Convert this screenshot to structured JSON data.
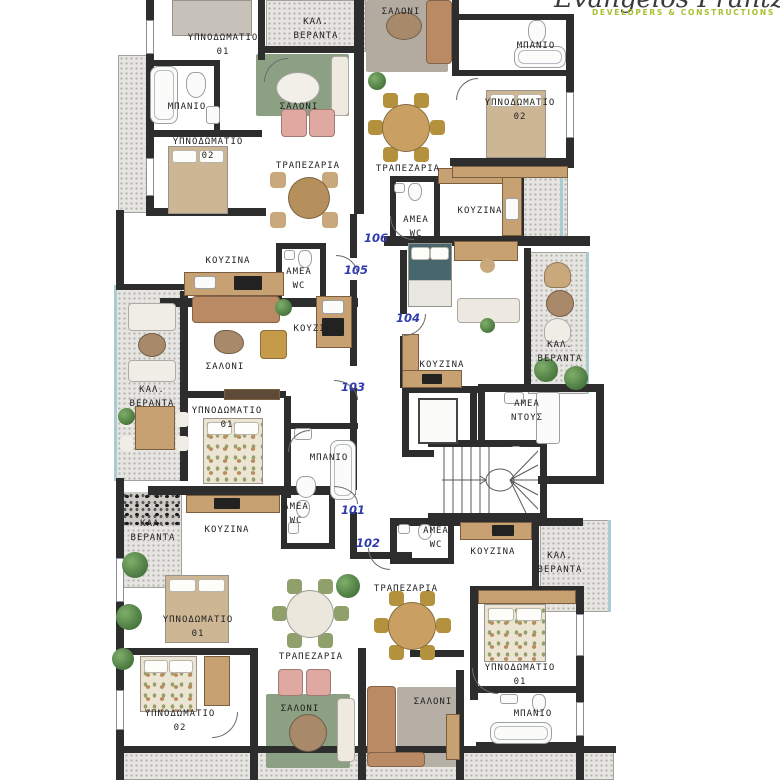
{
  "brand": {
    "name": "Evangelos Frantzis",
    "tagline": "DEVELOPERS & CONSTRUCTIONS"
  },
  "room_names": {
    "bedroom01": "ΥΠΝΟΔΩΜΑΤΙΟ\n01",
    "bedroom02": "ΥΠΝΟΔΩΜΑΤΙΟ\n02",
    "bathroom": "ΜΠΑΝΙΟ",
    "salon": "ΣΑΛΟΝΙ",
    "dining": "ΤΡΑΠΕΖΑΡΙΑ",
    "kitchen": "ΚΟΥΖΙΝΑ",
    "veranda": "ΚΑΛ.\nΒΕΡΑΝΤΑ",
    "amea_wc": "ΑΜΕΑ\nWC",
    "amea_shower": "ΑΜΕΑ\nΝΤΟΥΣ"
  },
  "unit_numbers": {
    "u101": "101",
    "u102": "102",
    "u103": "103",
    "u104": "104",
    "u105": "105",
    "u106": "106"
  },
  "colors": {
    "wall": "#2d2d2d",
    "unit_number": "#2f3cae",
    "brand_tagline": "#a6c130"
  }
}
